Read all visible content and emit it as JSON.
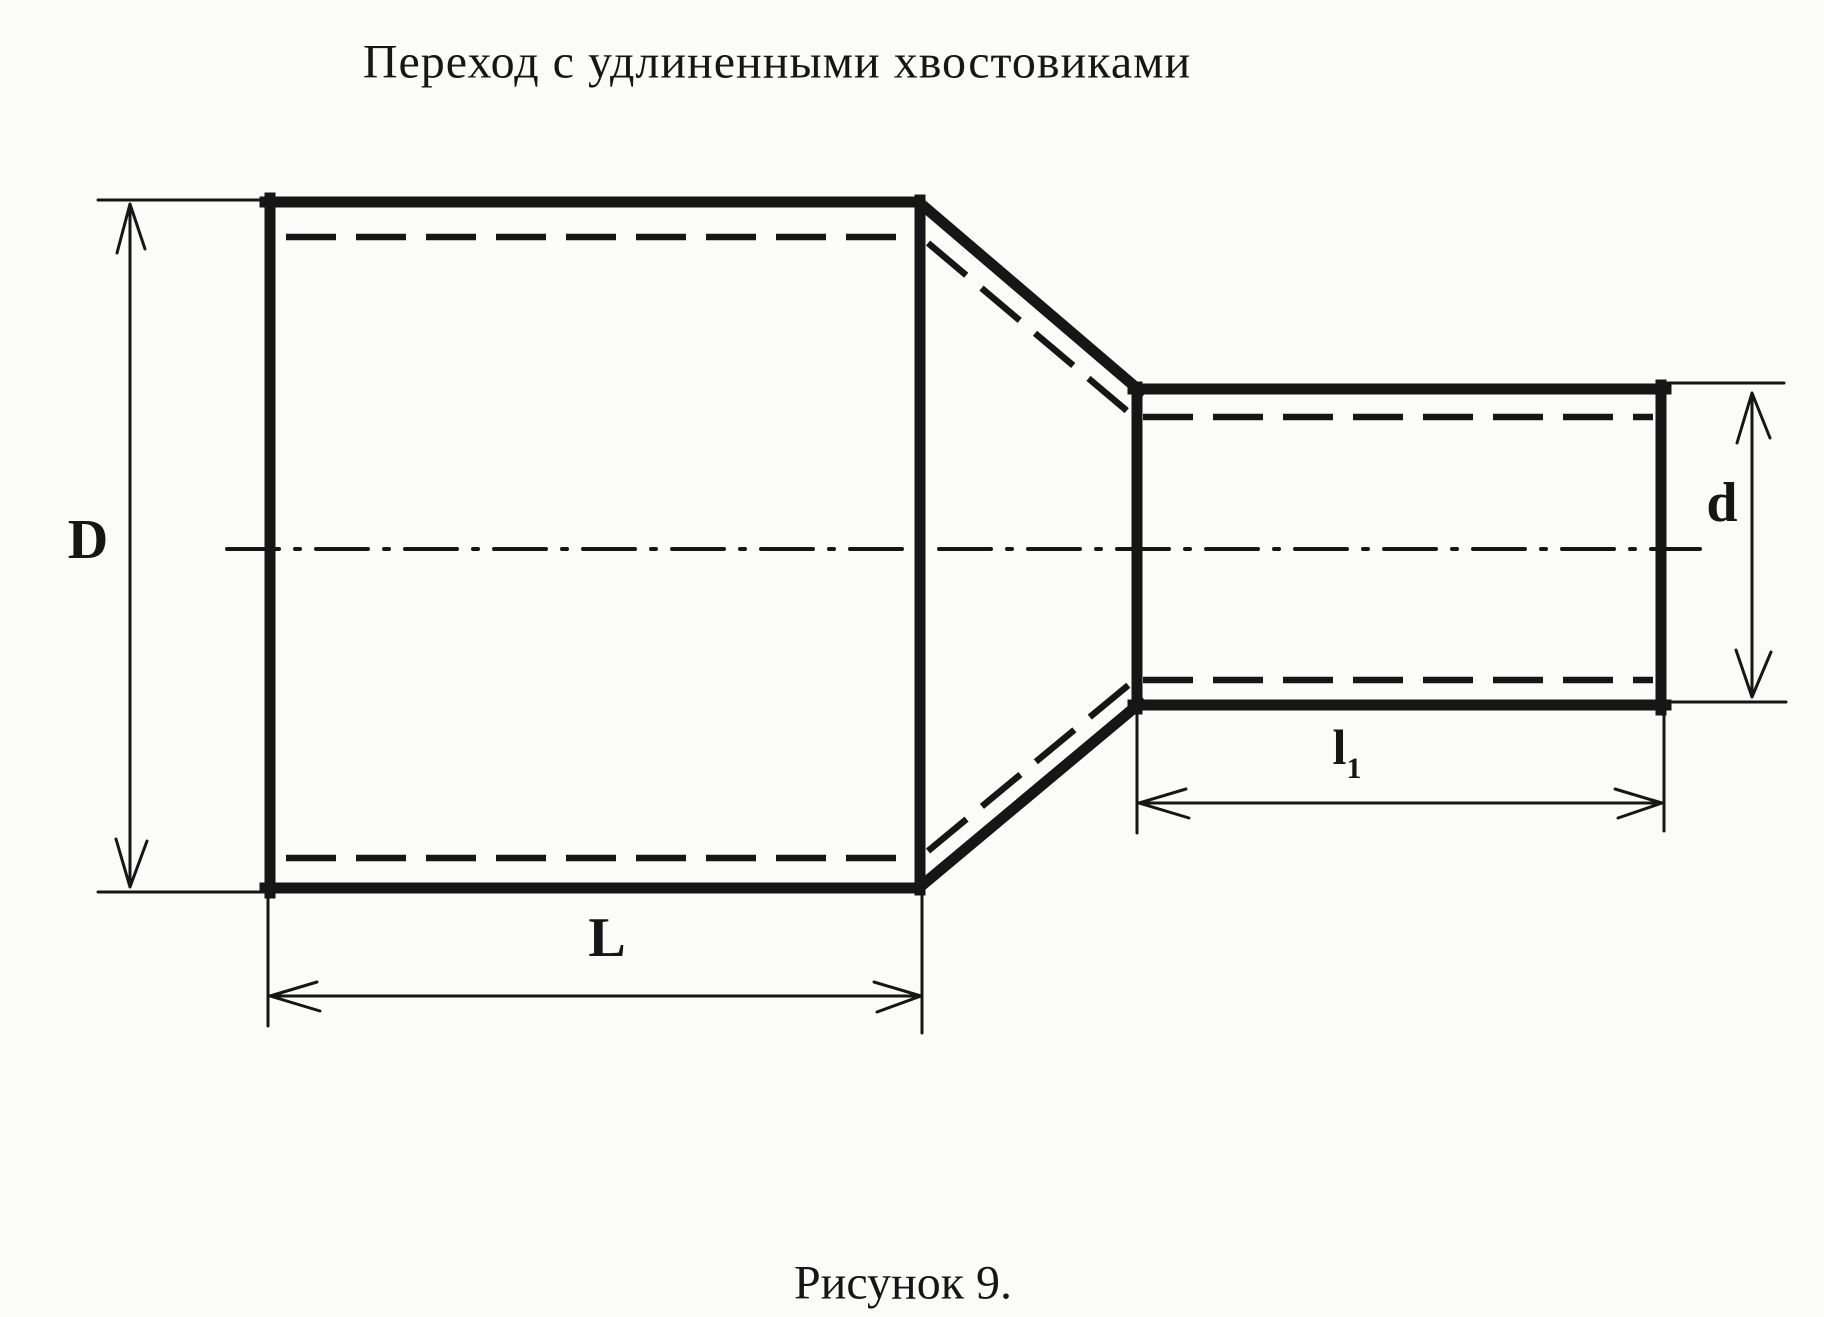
{
  "title": "Переход с удлиненными хвостовиками",
  "caption": "Рисунок 9.",
  "dimensions": {
    "large_diameter": "D",
    "large_length": "L",
    "small_diameter": "d",
    "small_length_base": "l",
    "small_length_sub": "1"
  },
  "colors": {
    "ink": "#161616",
    "paper": "#fbfbf8"
  }
}
